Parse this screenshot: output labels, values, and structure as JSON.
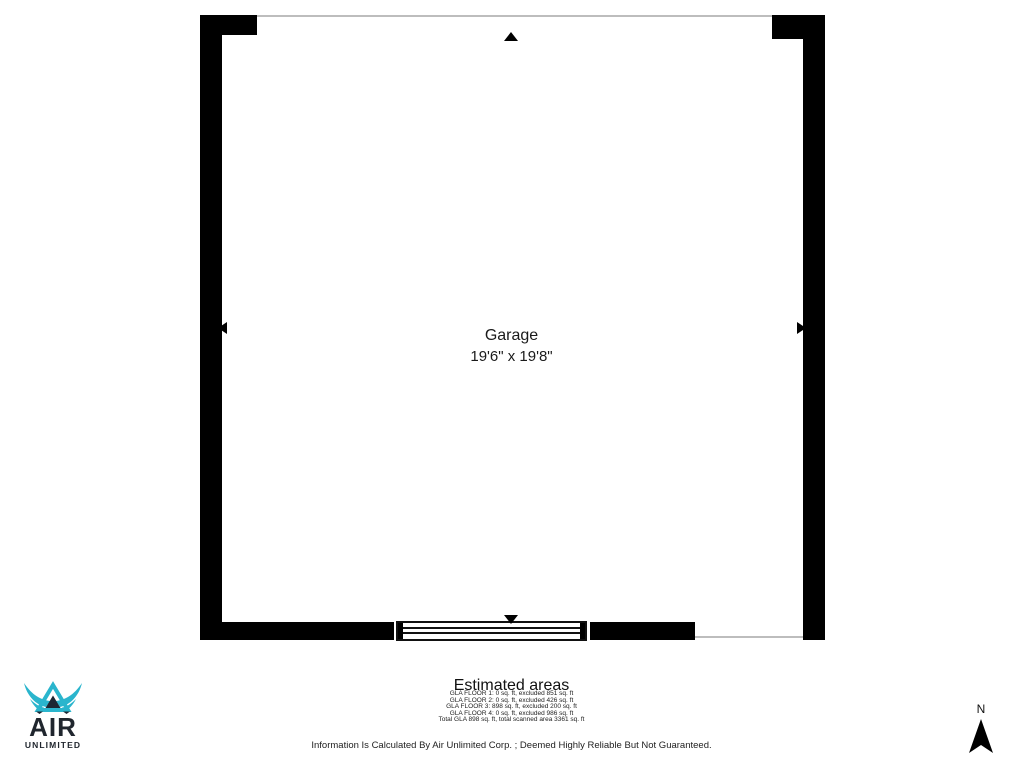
{
  "plan": {
    "room_label": "Garage",
    "room_dimensions": "19'6\" x 19'8\"",
    "wall_color": "#000000",
    "opening_line_color": "#bdbdbd"
  },
  "estimated_areas": {
    "title": "Estimated areas",
    "lines": [
      "GLA FLOOR 1: 0 sq. ft, excluded 851 sq. ft",
      "GLA FLOOR 2: 0 sq. ft, excluded 426 sq. ft",
      "GLA FLOOR 3: 898 sq. ft, excluded 200 sq. ft",
      "GLA FLOOR 4: 0 sq. ft, excluded 986 sq. ft",
      "Total GLA 898 sq. ft, total scanned area 3361 sq. ft"
    ],
    "disclaimer": "Information Is Calculated By Air Unlimited Corp. ; Deemed Highly Reliable But Not Guaranteed."
  },
  "branding": {
    "name_line1": "AIR",
    "name_line2": "UNLIMITED",
    "accent_color": "#2ab5cd",
    "dark_color": "#1d2733"
  },
  "compass": {
    "north_label": "N"
  }
}
